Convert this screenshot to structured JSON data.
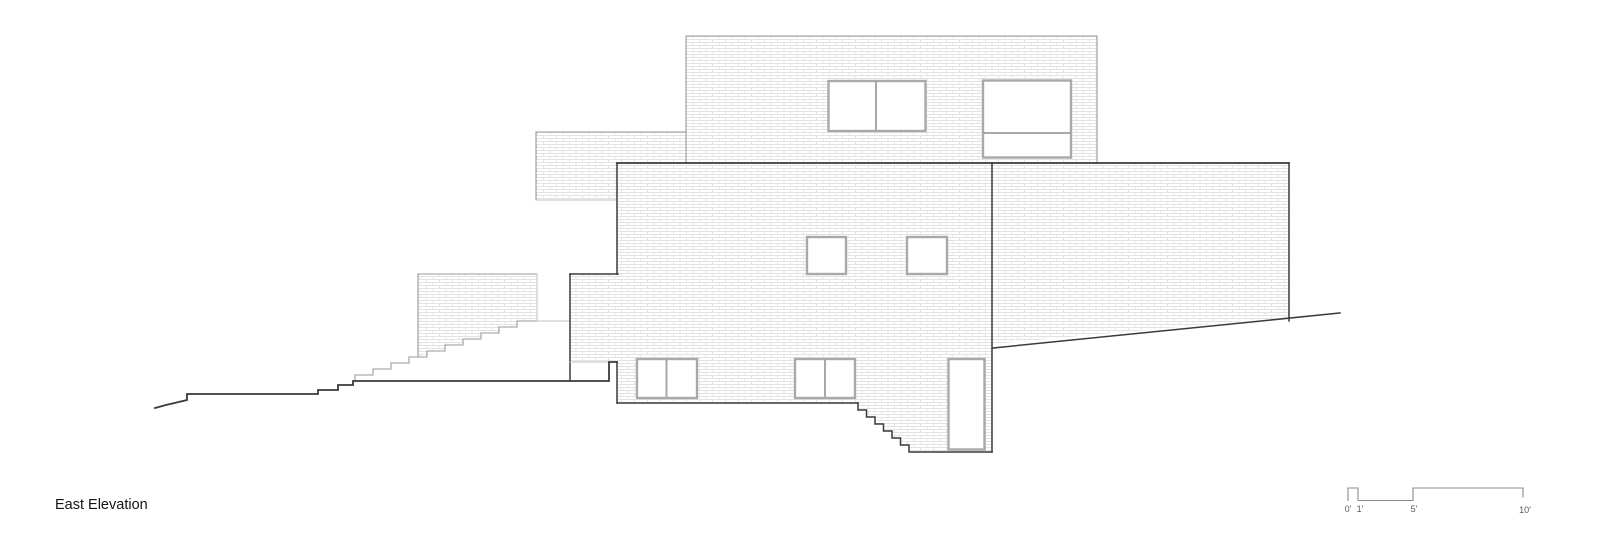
{
  "drawing": {
    "title": "East Elevation"
  },
  "scale_bar": {
    "labels": [
      "0'",
      "1'",
      "5'",
      "10'"
    ]
  },
  "colors": {
    "background": "#ffffff",
    "outline_dark": "#3a3a3a",
    "outline_light": "#9a9a9a",
    "outline_faint": "#c2c2c2",
    "hatch_line": "#e3e3e3",
    "window_frame": "#a9a9a9",
    "title_text": "#141414",
    "scale_text": "#5a5a5a",
    "scale_line": "#8c8c8c"
  }
}
